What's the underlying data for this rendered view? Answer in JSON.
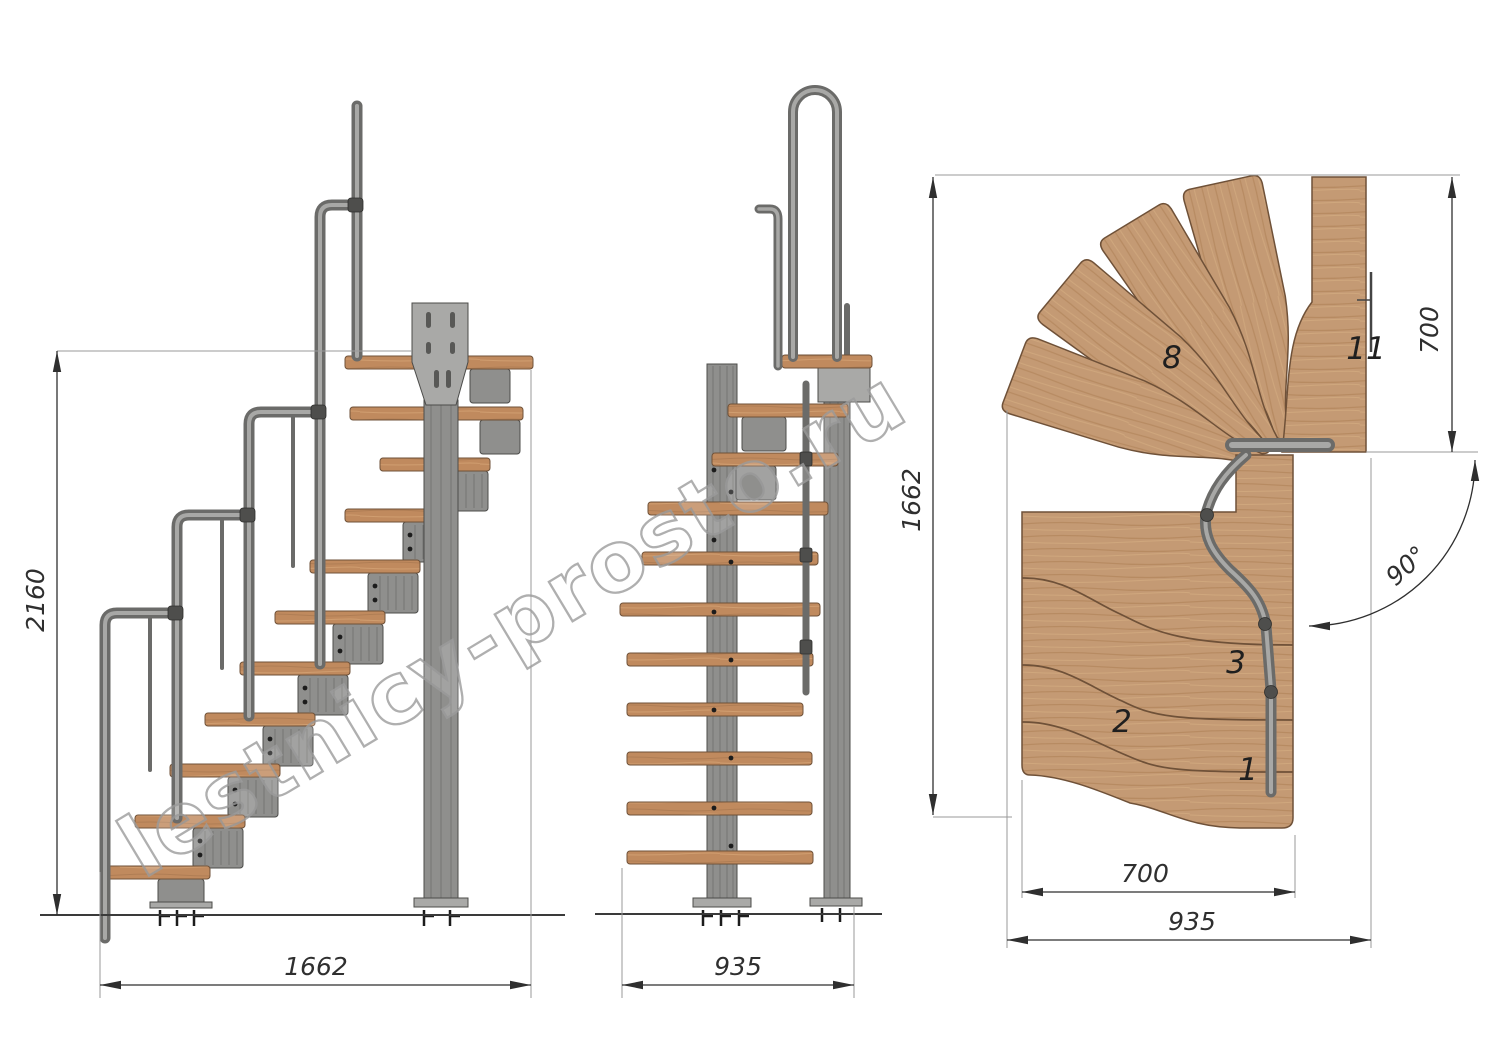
{
  "watermark": "lestnicy-prosto.ru",
  "dimensions": {
    "side_total_height": "2160",
    "side_total_run": "1662",
    "front_total_width": "935",
    "plan_total_depth": "1662",
    "plan_upper_flight_depth": "700",
    "plan_turn_angle": "90°",
    "plan_lower_flight_width": "700",
    "plan_overall_width": "935"
  },
  "step_labels": {
    "s1": "1",
    "s2": "2",
    "s3": "3",
    "s8": "8",
    "s11": "11"
  },
  "colors": {
    "background": "#ffffff",
    "wood": "#c49a74",
    "wood_side": "#bf8a5d",
    "wood_edge": "#6f5138",
    "metal": "#8f8f8d",
    "metal_dark": "#4c4c4a",
    "line": "#2f2f2f",
    "ext_line": "#9a9a9a",
    "watermark": "#9c9c9c"
  }
}
